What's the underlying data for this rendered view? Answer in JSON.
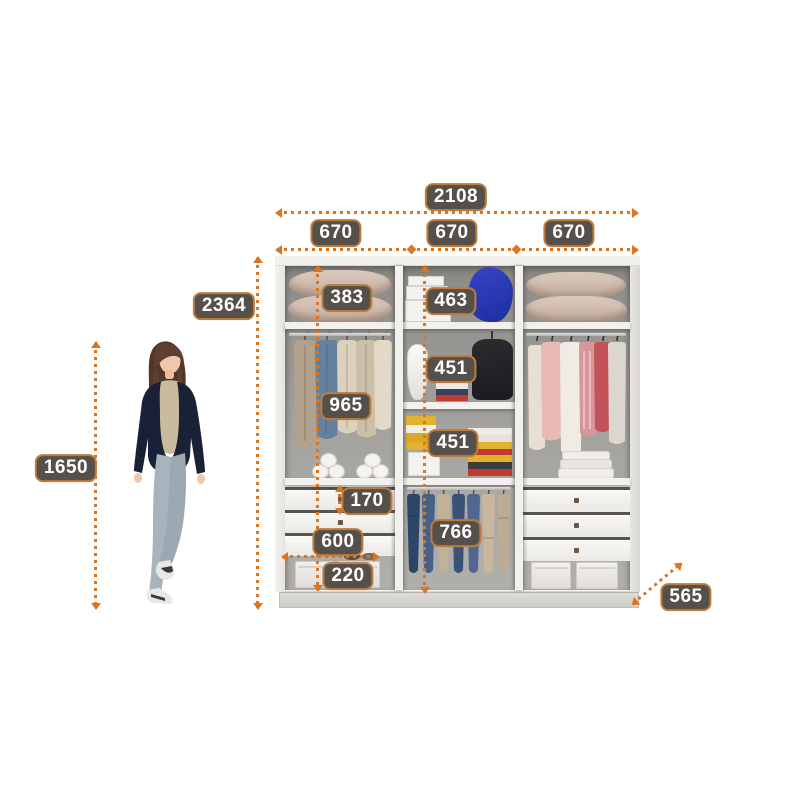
{
  "colors": {
    "accent": "#dd7420",
    "label_bg": "#55504a",
    "label_border": "#bf7b3a",
    "label_text": "#ffffff"
  },
  "labels": {
    "total_width": "2108",
    "section_width_left": "670",
    "section_width_middle": "670",
    "section_width_right": "670",
    "cabinet_height": "2364",
    "person_height": "1650",
    "left_top_shelf_height": "383",
    "middle_top_shelf_height": "463",
    "left_hanging_height": "965",
    "middle_upper_shelf_height": "451",
    "middle_lower_shelf_height": "451",
    "drawer_height": "170",
    "drawer_width": "600",
    "middle_hanging_height": "766",
    "base_compartment_height": "220",
    "depth": "565"
  }
}
